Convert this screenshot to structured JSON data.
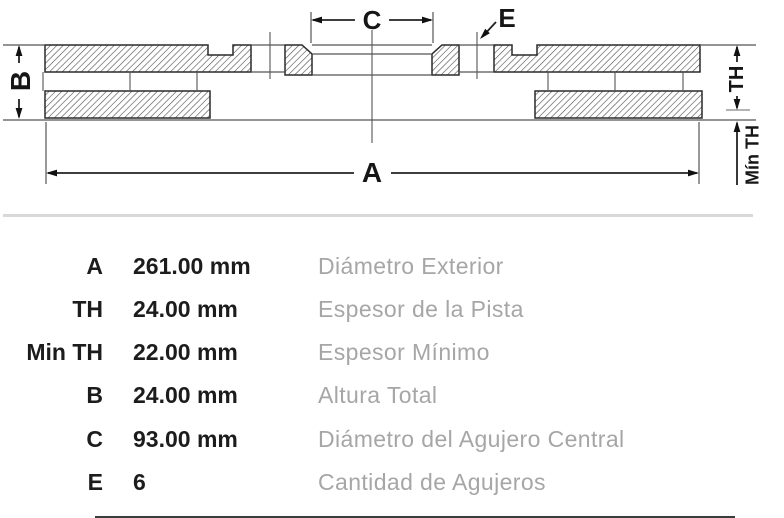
{
  "diagram": {
    "labels": {
      "a": "A",
      "b": "B",
      "c": "C",
      "e": "E",
      "th": "TH",
      "min_th": "Mín TH"
    }
  },
  "table": {
    "rows": [
      {
        "key": "A",
        "value": "261.00 mm",
        "desc": "Diámetro Exterior"
      },
      {
        "key": "TH",
        "value": "24.00 mm",
        "desc": "Espesor de la Pista"
      },
      {
        "key": "Min TH",
        "value": "22.00 mm",
        "desc": "Espesor Mínimo"
      },
      {
        "key": "B",
        "value": "24.00 mm",
        "desc": "Altura Total"
      },
      {
        "key": "C",
        "value": "93.00 mm",
        "desc": "Diámetro del Agujero Central"
      },
      {
        "key": "E",
        "value": "6",
        "desc": "Cantidad de Agujeros"
      }
    ]
  },
  "colors": {
    "ink": "#1c1c1c",
    "description_text": "#a6a6a6",
    "divider": "#d8d8d8"
  }
}
